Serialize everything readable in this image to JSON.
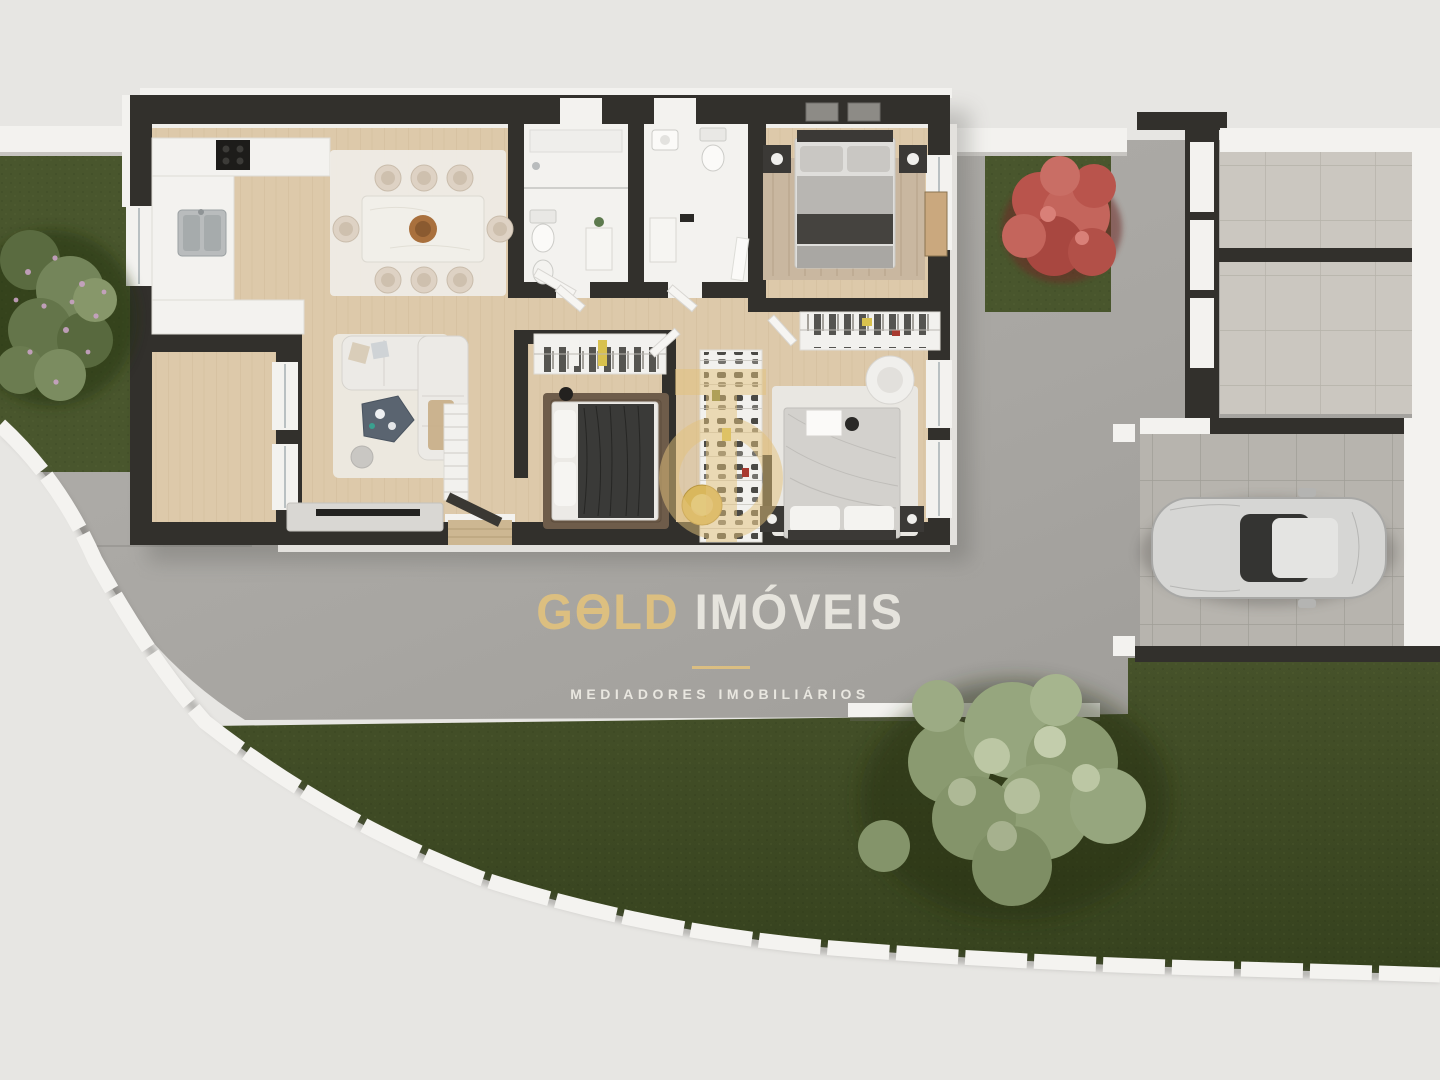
{
  "watermark": {
    "brand_g": "G",
    "brand_o": "O",
    "brand_ld": "LD",
    "brand_imoveis": "IMÓVEIS",
    "tagline": "MEDIADORES IMOBILIÁRIOS"
  },
  "colors": {
    "bg": "#e7e6e3",
    "concrete": "#a9a7a3",
    "wall": "#32302c",
    "white": "#f3f2ef",
    "wood": "#ddc9aa",
    "tile": "#b7b4ae",
    "tile_light": "#cbc7c0",
    "lawn": "#3f4b24",
    "grass": "#49562d",
    "gold": "#e4c37c",
    "cream": "#efede6",
    "red_tree": "#b9544c",
    "sage_tree": "#a3b28c",
    "car": "#d6d6d4",
    "glass": "#343432",
    "rug_dark": "#6e5c4a"
  }
}
